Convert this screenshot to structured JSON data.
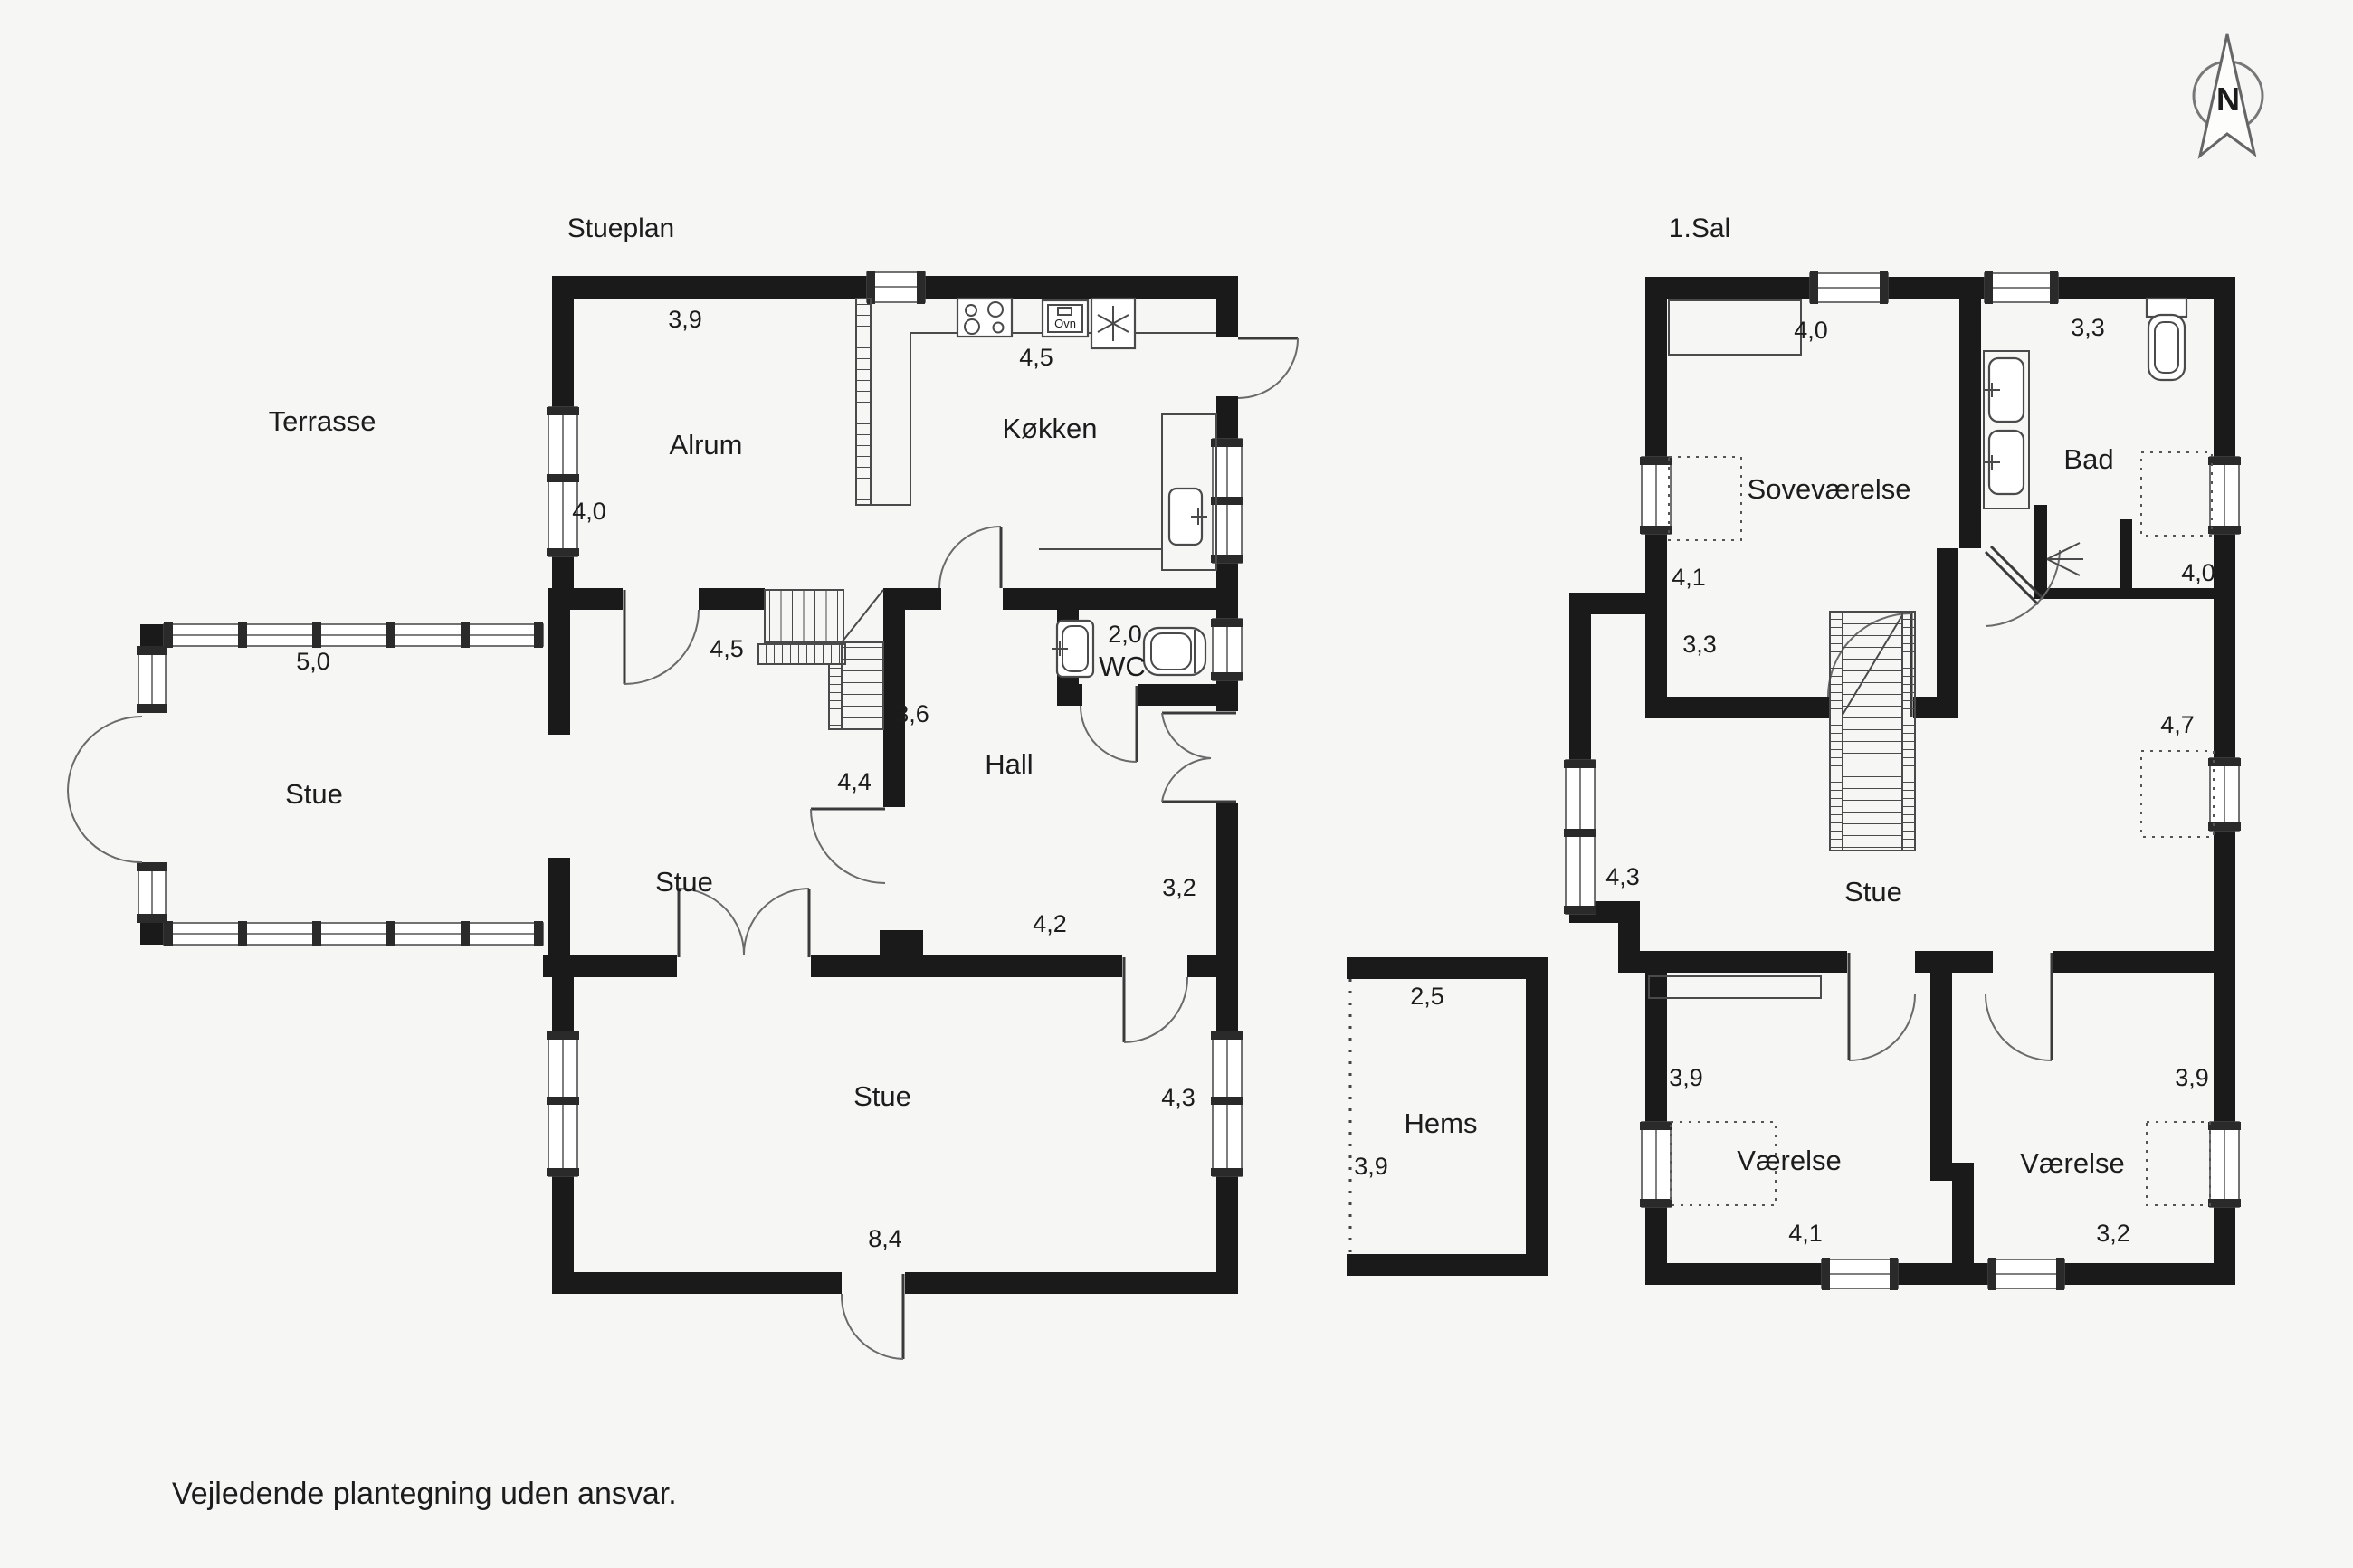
{
  "footer": "Vejledende plantegning uden ansvar.",
  "compass": {
    "label": "N"
  },
  "stueplan": {
    "title": "Stueplan",
    "rooms": {
      "terr": "Terrasse",
      "alrum": "Alrum",
      "kokken": "Køkken",
      "stue_glass": "Stue",
      "stue_mid": "Stue",
      "hall": "Hall",
      "wc": "WC",
      "stue_bottom": "Stue"
    },
    "dims": {
      "alrum_top": "3,9",
      "alrum_left": "4,0",
      "kokken_top": "4,5",
      "glass_top": "5,0",
      "stue_mid_top": "4,5",
      "stair": "3,6",
      "stue_mid": "4,4",
      "wc": "2,0",
      "hall_right": "3,2",
      "hall_bottom": "4,2",
      "stue_bottom_right": "4,3",
      "stue_bottom": "8,4"
    },
    "oven_label": "Ovn"
  },
  "sal": {
    "title": "1.Sal",
    "rooms": {
      "sove": "Soveværelse",
      "bad": "Bad",
      "stue": "Stue",
      "vaerelse_left": "Værelse",
      "vaerelse_right": "Værelse"
    },
    "dims": {
      "sove_top": "4,0",
      "bad_top": "3,3",
      "sove_left": "4,1",
      "bad_right": "4,0",
      "stue_topleft": "3,3",
      "stue_left": "4,3",
      "stue_right": "4,7",
      "v_left_top": "3,9",
      "v_right_top": "3,9",
      "v_left_bottom": "4,1",
      "v_right_bottom": "3,2"
    }
  },
  "hems": {
    "room": "Hems",
    "dims": {
      "top": "2,5",
      "left": "3,9"
    }
  }
}
